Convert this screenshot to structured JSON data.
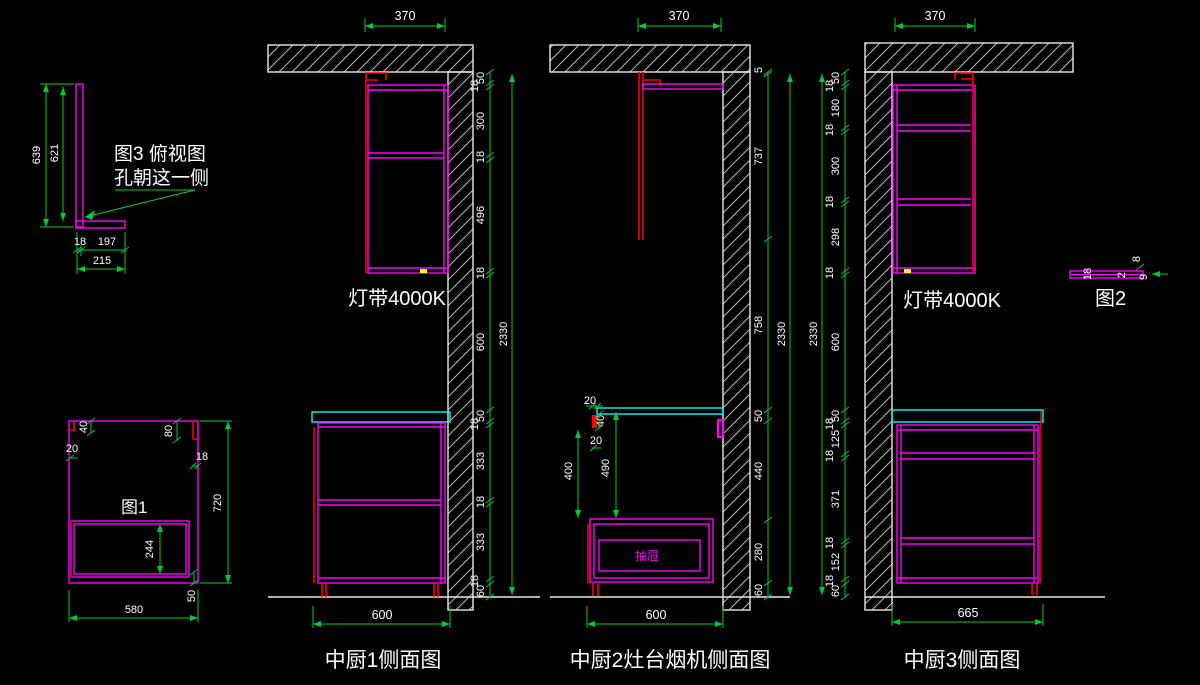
{
  "colors": {
    "background": "#000000",
    "cabinet_outline": "#ff00ff",
    "door_red": "#ff0000",
    "countertop_cyan": "#00ffff",
    "dimension_green": "#00cc33",
    "text_white": "#ffffff",
    "light_mark_yellow": "#ffff00"
  },
  "detail_fig3": {
    "title_line1": "图3 俯视图",
    "title_line2": "孔朝这一侧",
    "dim_639": "639",
    "dim_621": "621",
    "dim_18": "18",
    "dim_197": "197",
    "dim_215": "215"
  },
  "detail_fig1": {
    "name": "图1",
    "dim_40": "40",
    "dim_20": "20",
    "dim_80": "80",
    "dim_18": "18",
    "dim_720": "720",
    "dim_244": "244",
    "dim_580": "580",
    "dim_50": "50"
  },
  "view1": {
    "name": "中厨1侧面图",
    "light_label": "灯带4000K",
    "dim_top": "370",
    "dim_bottom": "600",
    "dim_overall": "2330",
    "chain": [
      "50",
      "18",
      "300",
      "18",
      "496",
      "18",
      "600",
      "50",
      "18",
      "333",
      "18",
      "333",
      "18",
      "60"
    ]
  },
  "view2": {
    "name": "中厨2灶台烟机侧面图",
    "drawer_label": "抽屉",
    "dim_top": "370",
    "dim_bottom": "600",
    "dim_overall": "2330",
    "dim_20_top": "20",
    "dim_40": "40",
    "dim_20_bottom": "20",
    "dim_400": "400",
    "dim_490": "490",
    "chain": [
      "5",
      "737",
      "758",
      "50",
      "440",
      "280",
      "60"
    ]
  },
  "view3": {
    "name": "中厨3侧面图",
    "light_label": "灯带4000K",
    "dim_top": "370",
    "dim_bottom": "665",
    "dim_overall": "2330",
    "chain": [
      "50",
      "18",
      "180",
      "18",
      "300",
      "18",
      "298",
      "18",
      "600",
      "50",
      "18",
      "125",
      "18",
      "371",
      "18",
      "152",
      "18",
      "60"
    ]
  },
  "detail_fig2": {
    "name": "图2",
    "dim_18": "18",
    "dim_2": "2",
    "dim_8": "8",
    "dim_9": "9"
  }
}
